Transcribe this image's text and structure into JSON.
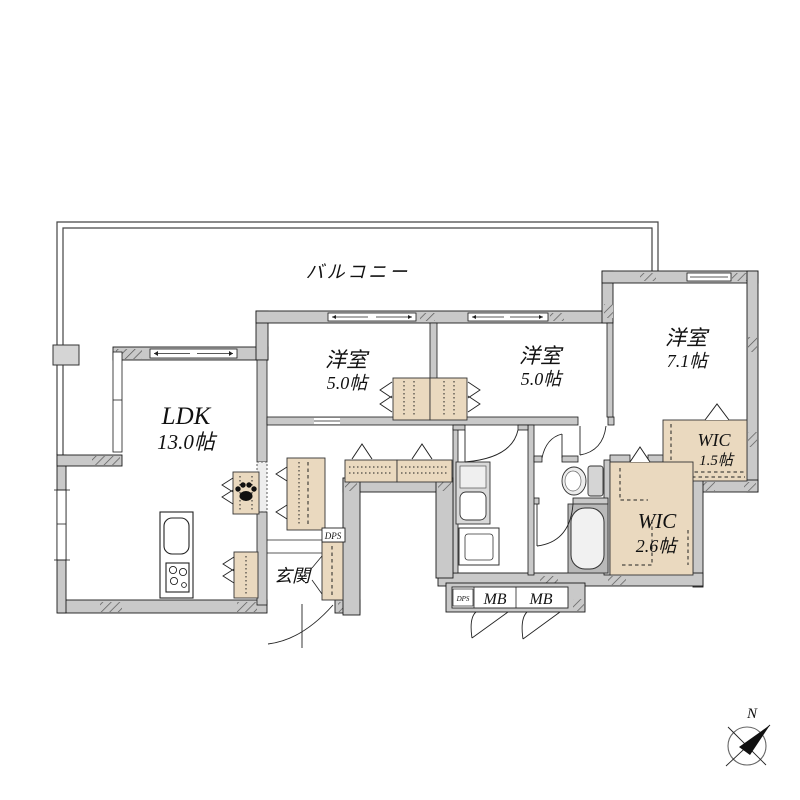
{
  "floorplan": {
    "balcony": {
      "label": "バルコニー"
    },
    "rooms": {
      "room1": {
        "name": "洋室",
        "size": "5.0帖"
      },
      "room2": {
        "name": "洋室",
        "size": "5.0帖"
      },
      "room3": {
        "name": "洋室",
        "size": "7.1帖"
      },
      "ldk": {
        "name": "LDK",
        "size": "13.0帖"
      },
      "wic1": {
        "name": "WIC",
        "size": "1.5帖"
      },
      "wic2": {
        "name": "WIC",
        "size": "2.6帖"
      },
      "genkan": {
        "label": "玄関"
      }
    },
    "utility": {
      "dps_upper": "DPS",
      "dps_lower": "DPS",
      "mb1": "MB",
      "mb2": "MB"
    },
    "compass": {
      "north": "N"
    },
    "colors": {
      "wall_fill": "#c9c9c9",
      "closet_fill": "#ead9bf",
      "line": "#1a1a1a",
      "background": "#ffffff"
    }
  }
}
